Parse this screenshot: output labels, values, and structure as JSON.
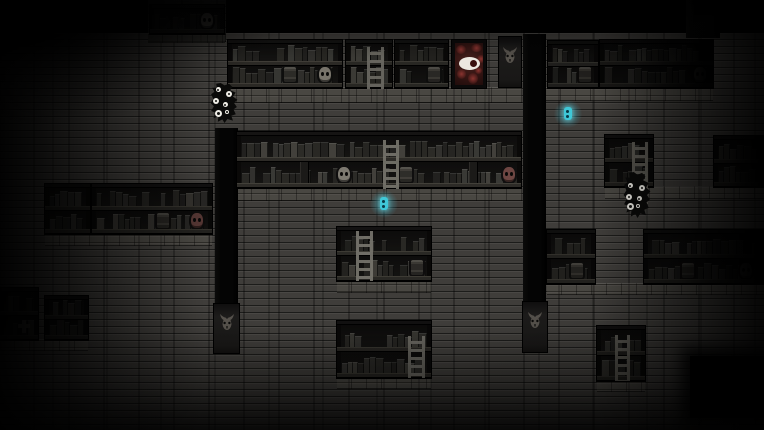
{
  "scene": {
    "canvas": {
      "width": 764,
      "height": 430,
      "background": "#000000"
    },
    "palette": {
      "wall_base": "#3f3d3a",
      "wall_seam": "#232220",
      "shelf_frame": "#0d0c0b",
      "shelf_back": "#161514",
      "shelf_board": "#3a3833",
      "pillar": "#040404",
      "banner": "#191817",
      "banner_face": "#56524c",
      "painting_red": "#8a3430",
      "painting_eye_white": "#ece7e0",
      "skull_gray": "#a19b90",
      "skull_red": "#8d5a55",
      "orb_cyan": "#3fc8d8",
      "creature_black": "#0a0a09",
      "creature_eye_white": "#efede6",
      "book_palette": [
        "#35342f",
        "#403f3b",
        "#2c2b28",
        "#4a4944",
        "#393833",
        "#55534c",
        "#31302c"
      ]
    },
    "walls": [
      {
        "name": "wall-main",
        "x": 0,
        "y": 33,
        "w": 764,
        "h": 397,
        "dim": false
      },
      {
        "name": "wall-top-left",
        "x": 148,
        "y": 0,
        "w": 78,
        "h": 42,
        "dim": true
      }
    ],
    "ledges": [
      {
        "x": 148,
        "y": 33,
        "w": 77,
        "h": 10
      },
      {
        "x": 222,
        "y": 87,
        "w": 300,
        "h": 16
      },
      {
        "x": 546,
        "y": 87,
        "w": 167,
        "h": 14
      },
      {
        "x": 237,
        "y": 187,
        "w": 285,
        "h": 14
      },
      {
        "x": 605,
        "y": 186,
        "w": 160,
        "h": 13
      },
      {
        "x": 45,
        "y": 233,
        "w": 167,
        "h": 13
      },
      {
        "x": 0,
        "y": 339,
        "w": 88,
        "h": 12
      },
      {
        "x": 337,
        "y": 280,
        "w": 94,
        "h": 13
      },
      {
        "x": 547,
        "y": 283,
        "w": 217,
        "h": 12
      },
      {
        "x": 337,
        "y": 377,
        "w": 94,
        "h": 12
      },
      {
        "x": 597,
        "y": 380,
        "w": 48,
        "h": 12
      }
    ],
    "pillars": [
      {
        "name": "pillar-left",
        "x": 215,
        "y": 128,
        "w": 23,
        "h": 177
      },
      {
        "name": "pillar-middle",
        "x": 523,
        "y": 34,
        "w": 23,
        "h": 269
      },
      {
        "name": "pillar-top-right",
        "x": 686,
        "y": 0,
        "w": 34,
        "h": 38
      }
    ],
    "banners": [
      {
        "name": "banner-demon-top",
        "x": 499,
        "y": 37,
        "w": 22,
        "h": 50
      },
      {
        "name": "banner-demon-left",
        "x": 214,
        "y": 304,
        "w": 25,
        "h": 49
      },
      {
        "name": "banner-demon-middle",
        "x": 523,
        "y": 302,
        "w": 24,
        "h": 50
      }
    ],
    "painting": {
      "name": "eye-creature-painting",
      "x": 452,
      "y": 40,
      "w": 34,
      "h": 48
    },
    "shelves": [
      {
        "name": "shelf-top-left",
        "x": 150,
        "y": 5,
        "w": 74,
        "h": 29,
        "rows": 1,
        "shade": 0.72,
        "seed": 1,
        "fadeRight": false,
        "items": [
          {
            "row": 1,
            "type": "bottle",
            "cx": 170
          },
          {
            "row": 1,
            "type": "bottle",
            "cx": 183
          },
          {
            "row": 1,
            "type": "skull",
            "cx": 207,
            "tint": "gray"
          }
        ]
      },
      {
        "name": "shelf-row1-a",
        "x": 228,
        "y": 40,
        "w": 114,
        "h": 48,
        "rows": 2,
        "shade": 0.26,
        "seed": 2,
        "fadeRight": false,
        "items": [
          {
            "row": 1,
            "type": "jar",
            "cx": 290
          },
          {
            "row": 1,
            "type": "skull",
            "cx": 325,
            "tint": "gray"
          }
        ]
      },
      {
        "name": "shelf-row1-b",
        "x": 346,
        "y": 40,
        "w": 46,
        "h": 48,
        "rows": 2,
        "shade": 0.3,
        "seed": 3,
        "fadeRight": false,
        "items": []
      },
      {
        "name": "shelf-row1-c",
        "x": 395,
        "y": 40,
        "w": 53,
        "h": 48,
        "rows": 2,
        "shade": 0.3,
        "seed": 4,
        "fadeRight": false,
        "items": [
          {
            "row": 1,
            "type": "jar",
            "cx": 434
          }
        ]
      },
      {
        "name": "shelf-row1-d",
        "x": 548,
        "y": 41,
        "w": 50,
        "h": 47,
        "rows": 2,
        "shade": 0.45,
        "seed": 5,
        "fadeRight": false,
        "items": [
          {
            "row": 1,
            "type": "jar",
            "cx": 585
          }
        ]
      },
      {
        "name": "shelf-row1-e",
        "x": 600,
        "y": 40,
        "w": 113,
        "h": 48,
        "rows": 2,
        "shade": 0.58,
        "seed": 6,
        "fadeRight": true,
        "items": [
          {
            "row": 1,
            "type": "skull",
            "cx": 700,
            "tint": "gray"
          }
        ]
      },
      {
        "name": "shelf-row2-main",
        "x": 237,
        "y": 132,
        "w": 284,
        "h": 56,
        "rows": 2,
        "shade": 0.22,
        "seed": 7,
        "fadeRight": false,
        "items": [
          {
            "row": 1,
            "type": "tallbook",
            "cx": 306
          },
          {
            "row": 1,
            "type": "skull",
            "cx": 344,
            "tint": "gray"
          },
          {
            "row": 1,
            "type": "jar",
            "cx": 406
          },
          {
            "row": 1,
            "type": "tallbook",
            "cx": 475
          },
          {
            "row": 1,
            "type": "skull",
            "cx": 509,
            "tint": "red"
          }
        ]
      },
      {
        "name": "shelf-row2-right",
        "x": 605,
        "y": 135,
        "w": 48,
        "h": 52,
        "rows": 2,
        "shade": 0.48,
        "seed": 8,
        "fadeRight": false,
        "items": []
      },
      {
        "name": "shelf-row2-far-right",
        "x": 714,
        "y": 136,
        "w": 50,
        "h": 51,
        "rows": 2,
        "shade": 0.58,
        "seed": 9,
        "fadeRight": true,
        "items": []
      },
      {
        "name": "shelf-bottom-left-a",
        "x": 45,
        "y": 184,
        "w": 45,
        "h": 50,
        "rows": 2,
        "shade": 0.5,
        "seed": 10,
        "fadeRight": false,
        "items": []
      },
      {
        "name": "shelf-bottom-left-b",
        "x": 92,
        "y": 184,
        "w": 120,
        "h": 50,
        "rows": 2,
        "shade": 0.4,
        "seed": 11,
        "fadeRight": false,
        "items": [
          {
            "row": 1,
            "type": "jar",
            "cx": 163
          },
          {
            "row": 1,
            "type": "skull",
            "cx": 197,
            "tint": "red"
          }
        ]
      },
      {
        "name": "shelf-left-edge-a",
        "x": 0,
        "y": 288,
        "w": 38,
        "h": 52,
        "rows": 2,
        "shade": 0.55,
        "seed": 12,
        "fadeRight": false,
        "items": [
          {
            "row": 1,
            "type": "cross",
            "cx": 24
          }
        ]
      },
      {
        "name": "shelf-left-edge-b",
        "x": 45,
        "y": 296,
        "w": 43,
        "h": 44,
        "rows": 2,
        "shade": 0.55,
        "seed": 13,
        "fadeRight": false,
        "items": []
      },
      {
        "name": "shelf-row3-middle",
        "x": 337,
        "y": 227,
        "w": 94,
        "h": 54,
        "rows": 2,
        "shade": 0.28,
        "seed": 14,
        "fadeRight": false,
        "items": [
          {
            "row": 1,
            "type": "jar",
            "cx": 417
          }
        ]
      },
      {
        "name": "shelf-row3-right",
        "x": 547,
        "y": 230,
        "w": 48,
        "h": 54,
        "rows": 2,
        "shade": 0.42,
        "seed": 15,
        "fadeRight": false,
        "items": [
          {
            "row": 1,
            "type": "jar",
            "cx": 577
          }
        ]
      },
      {
        "name": "shelf-row3-far-right",
        "x": 644,
        "y": 230,
        "w": 120,
        "h": 54,
        "rows": 2,
        "shade": 0.5,
        "seed": 16,
        "fadeRight": true,
        "items": [
          {
            "row": 1,
            "type": "jar",
            "cx": 688
          },
          {
            "row": 1,
            "type": "skull",
            "cx": 746,
            "tint": "gray"
          }
        ]
      },
      {
        "name": "shelf-row4-middle",
        "x": 337,
        "y": 321,
        "w": 94,
        "h": 57,
        "rows": 2,
        "shade": 0.36,
        "seed": 17,
        "fadeRight": false,
        "items": []
      },
      {
        "name": "shelf-row4-right",
        "x": 597,
        "y": 326,
        "w": 48,
        "h": 55,
        "rows": 2,
        "shade": 0.48,
        "seed": 18,
        "fadeRight": false,
        "items": []
      }
    ],
    "ladders": [
      {
        "name": "ladder-row1",
        "x": 367,
        "y": 47,
        "w": 17,
        "h": 42,
        "tone": "#6b6962"
      },
      {
        "name": "ladder-row2-main",
        "x": 383,
        "y": 140,
        "w": 16,
        "h": 49,
        "tone": "#75736b"
      },
      {
        "name": "ladder-row2-right",
        "x": 632,
        "y": 142,
        "w": 16,
        "h": 62,
        "tone": "#5e5c55"
      },
      {
        "name": "ladder-row3",
        "x": 356,
        "y": 231,
        "w": 17,
        "h": 50,
        "tone": "#77756d"
      },
      {
        "name": "ladder-row4-middle",
        "x": 408,
        "y": 336,
        "w": 17,
        "h": 42,
        "tone": "#6b6962"
      },
      {
        "name": "ladder-row4-right",
        "x": 615,
        "y": 335,
        "w": 15,
        "h": 46,
        "tone": "#5e5c55"
      }
    ],
    "creatures": [
      {
        "name": "black-many-eyed-creature-left",
        "x": 210,
        "y": 83,
        "w": 28,
        "h": 40,
        "eyes": [
          {
            "x": 6,
            "y": 4,
            "s": 5
          },
          {
            "x": 16,
            "y": 8,
            "s": 6
          },
          {
            "x": 3,
            "y": 15,
            "s": 6
          },
          {
            "x": 13,
            "y": 19,
            "s": 5
          },
          {
            "x": 5,
            "y": 27,
            "s": 7
          },
          {
            "x": 15,
            "y": 27,
            "s": 4
          }
        ]
      },
      {
        "name": "black-many-eyed-creature-right",
        "x": 623,
        "y": 172,
        "w": 28,
        "h": 46,
        "eyes": [
          {
            "x": 5,
            "y": 11,
            "s": 5
          },
          {
            "x": 16,
            "y": 13,
            "s": 6
          },
          {
            "x": 3,
            "y": 22,
            "s": 6
          },
          {
            "x": 14,
            "y": 24,
            "s": 5
          },
          {
            "x": 4,
            "y": 31,
            "s": 7
          },
          {
            "x": 13,
            "y": 32,
            "s": 4
          }
        ]
      }
    ],
    "orbs": [
      {
        "name": "glowing-cyan-orb-right",
        "cx": 568,
        "cy": 114
      },
      {
        "name": "glowing-cyan-orb-middle",
        "cx": 384,
        "cy": 204
      }
    ],
    "voids": [
      {
        "name": "dark-void-bottom-right",
        "x": 690,
        "y": 356,
        "w": 74,
        "h": 62
      }
    ]
  }
}
